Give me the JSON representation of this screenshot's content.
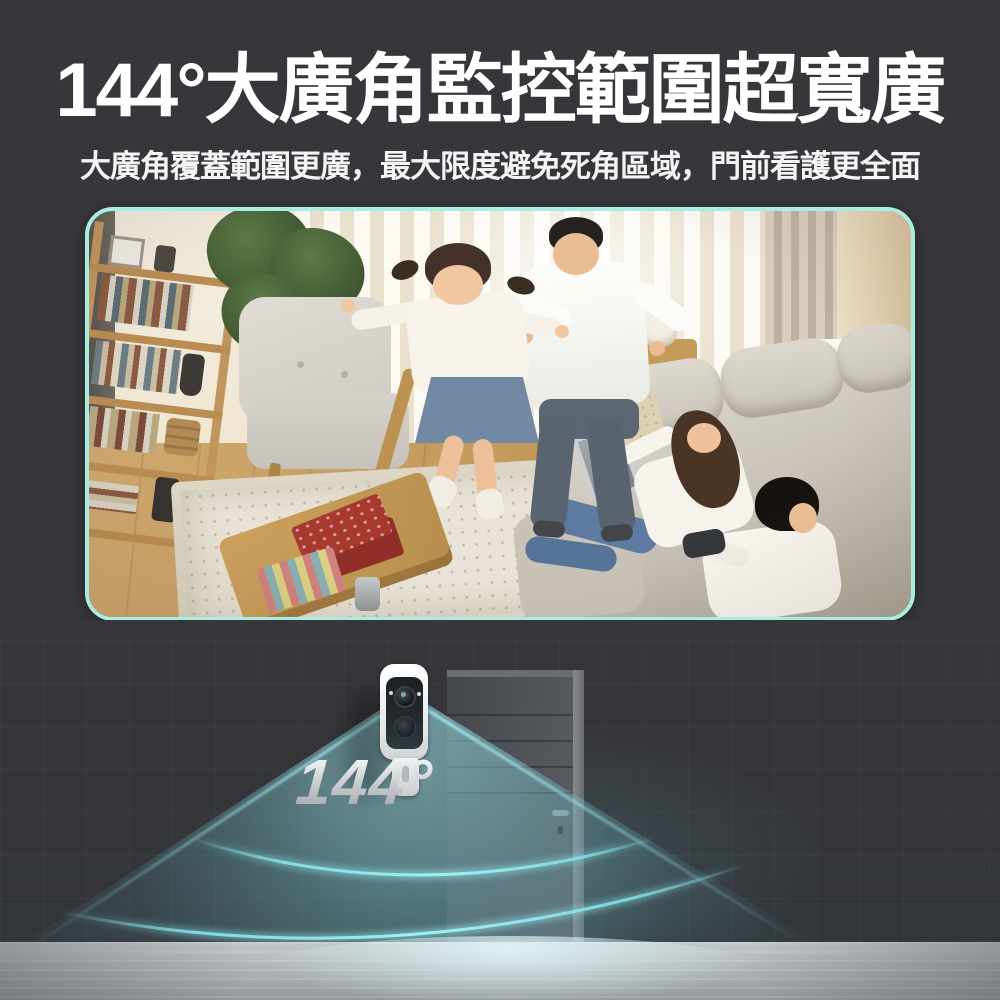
{
  "meta": {
    "background_color": "#37373b",
    "accent_border_color": "#a9ece1",
    "beam_color": "#7fd9df",
    "title_color": "#ffffff",
    "angle_text_color": "#c7cacd"
  },
  "header": {
    "title": "144°大廣角監控範圍超寬廣",
    "subtitle": "大廣角覆蓋範圍更廣，最大限度避免死角區域，門前看護更全面"
  },
  "preview": {
    "scene_description": "客廳廣角監控畫面：爸爸抱著女兒玩耍，媽媽拿平板與兒子拿遊戲手把坐在沙發上"
  },
  "demo": {
    "angle_label": "144°"
  }
}
